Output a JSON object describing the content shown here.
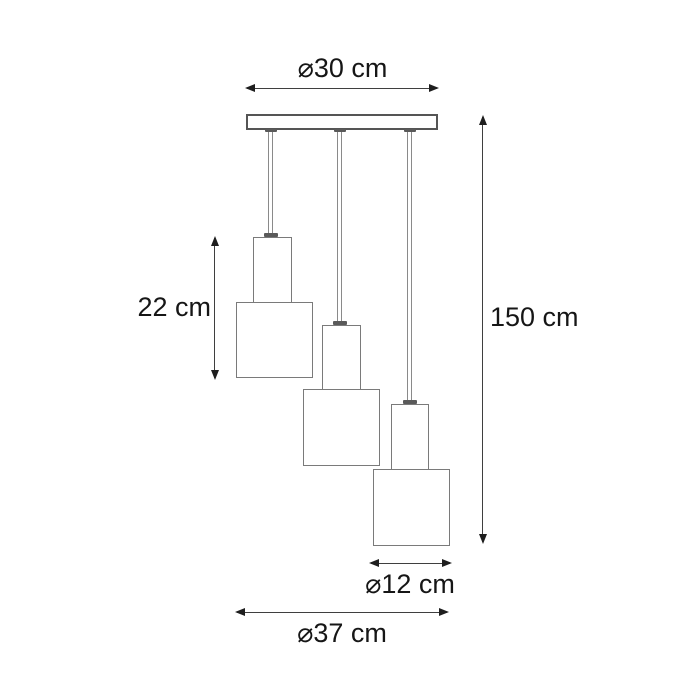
{
  "labels": {
    "canopy_diameter": "⌀30 cm",
    "shade_height": "22 cm",
    "total_height": "150 cm",
    "shade_diameter": "⌀12 cm",
    "total_width": "⌀37 cm"
  },
  "colors": {
    "background": "#ffffff",
    "dimension_line": "#3f3f3f",
    "arrowhead": "#1e1e1e",
    "canopy_outline": "#555555",
    "fixture_outline": "#7a7a7a",
    "cord": "#8a8a8a",
    "text": "#161616"
  },
  "icons": {
    "horizontal_arrow": [
      "arrowhead-left-icon",
      "arrowhead-right-icon"
    ],
    "vertical_arrow": [
      "arrowhead-up-icon",
      "arrowhead-down-icon"
    ]
  }
}
